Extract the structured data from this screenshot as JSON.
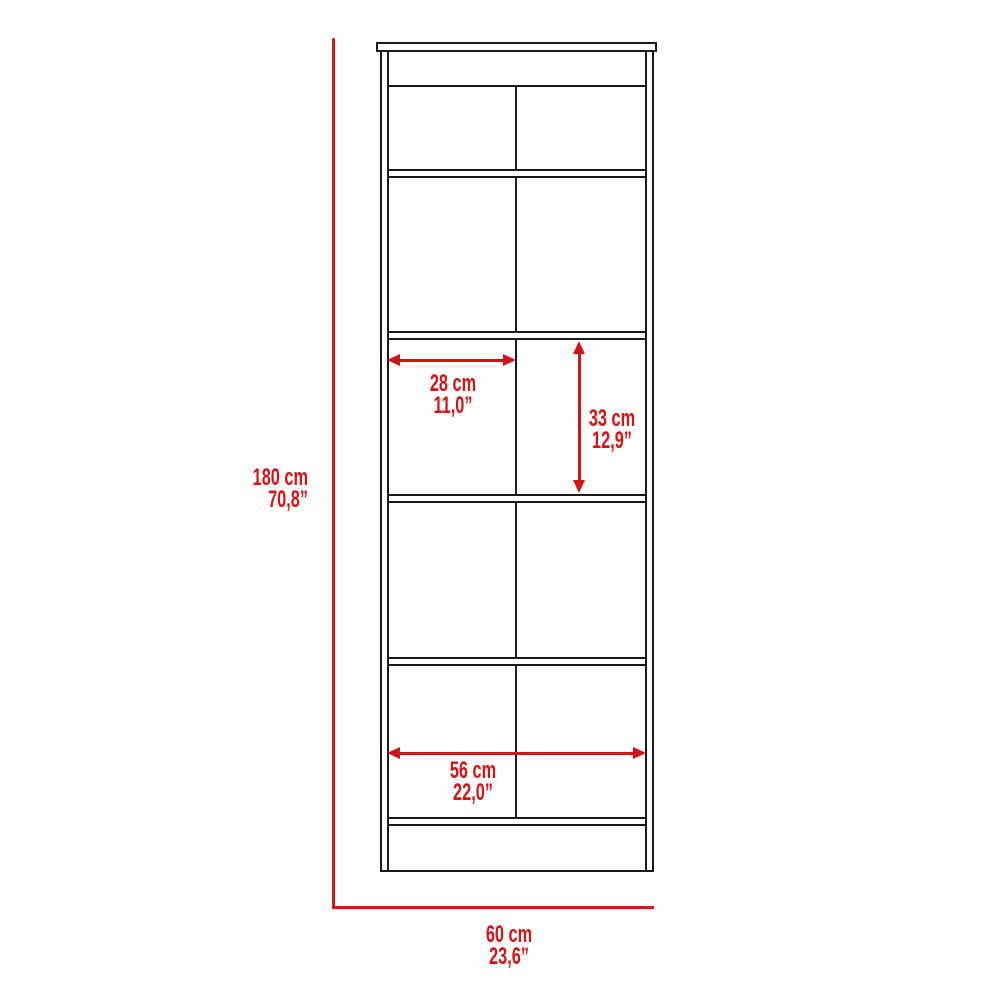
{
  "diagram": {
    "subject": "storage-cabinet-dimension-drawing",
    "measurements": {
      "overall_height": {
        "cm": "180 cm",
        "inch": "70,8”"
      },
      "overall_width": {
        "cm": "60 cm",
        "inch": "23,6”"
      },
      "cubby_width": {
        "cm": "28 cm",
        "inch": "11,0”"
      },
      "cubby_height": {
        "cm": "33 cm",
        "inch": "12,9”"
      },
      "inner_width": {
        "cm": "56 cm",
        "inch": "22,0”"
      }
    },
    "colors": {
      "dimension_red": "#d01518",
      "outline_black": "#1a1a1a",
      "background": "#ffffff"
    }
  }
}
